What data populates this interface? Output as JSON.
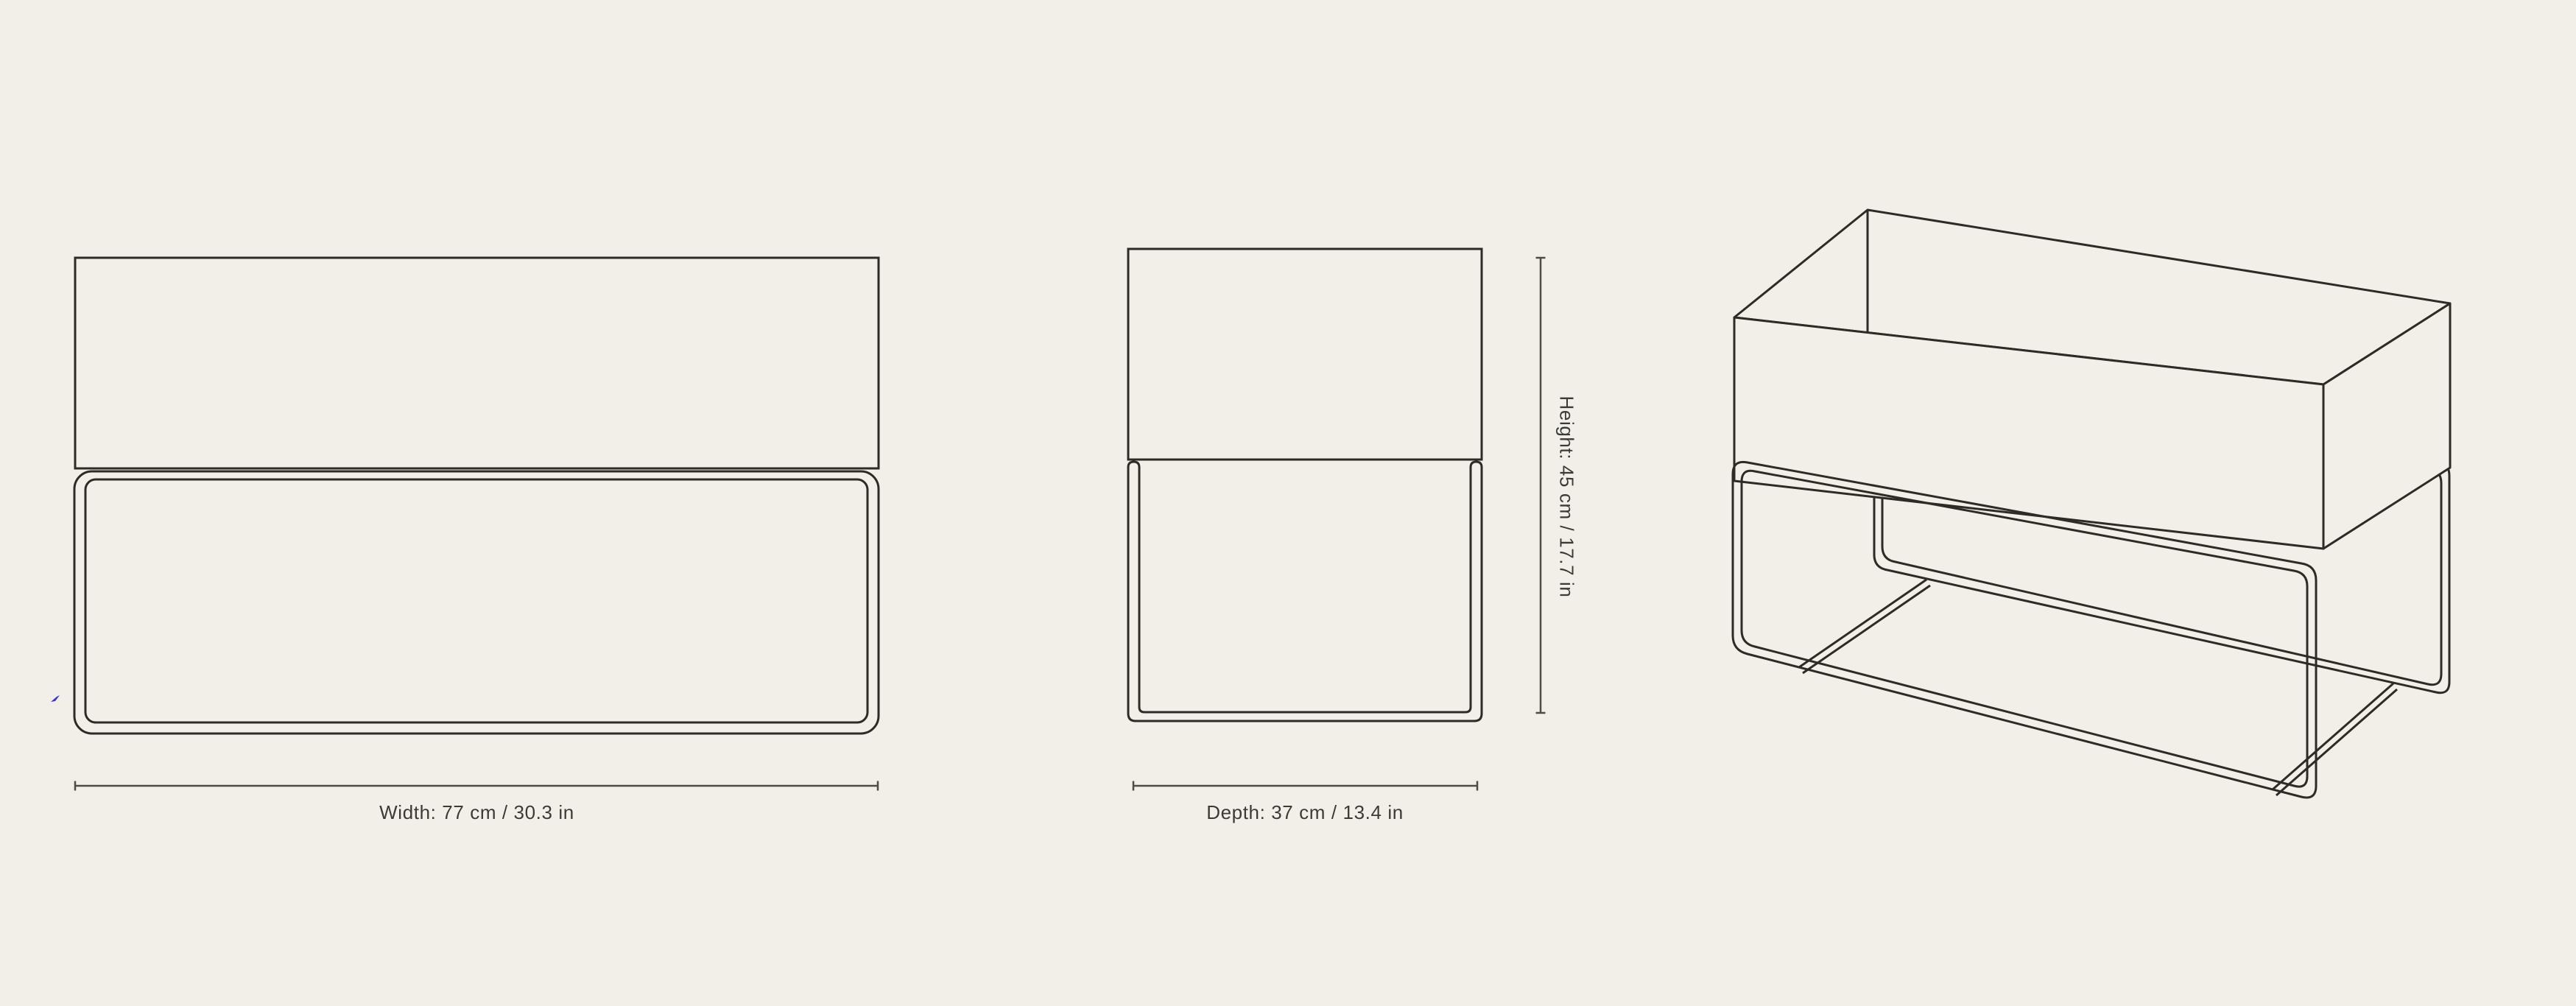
{
  "theme": {
    "background": "#f2efe9",
    "drawing_line": "#2e2b27",
    "dim_line": "#4f4b45",
    "text_color": "#3c3a36",
    "artifact_blue": "#3a31d8"
  },
  "views": {
    "front_view": {
      "width_label": "Width: 77 cm / 30.3 in"
    },
    "side_view": {
      "depth_label": "Depth: 37 cm / 13.4 in",
      "height_label": "Height: 45 cm / 17.7 in"
    }
  }
}
